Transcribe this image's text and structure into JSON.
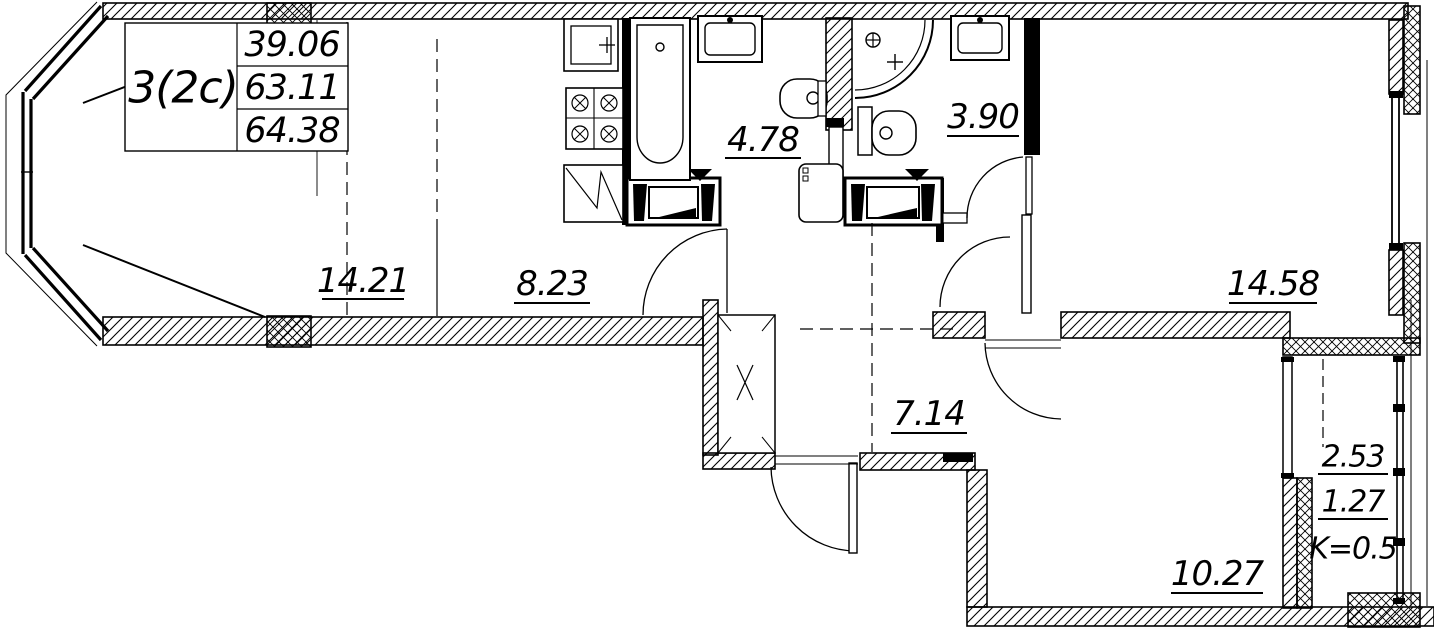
{
  "drawing": {
    "title_block": {
      "apartment_type": "3(2с)",
      "living_area": "39.06",
      "area": "63.11",
      "total_area": "64.38"
    },
    "room_labels": {
      "living": "14.21",
      "kitchen": "8.23",
      "bathroom": "4.78",
      "wc": "3.90",
      "bedroom_right": "14.58",
      "hallway": "7.14",
      "bedroom_bottom": "10.27",
      "balcony_full": "2.53",
      "balcony_reduced": "1.27",
      "balcony_coefficient": "K=0.5"
    },
    "colors": {
      "line": "#000000",
      "background": "#ffffff"
    }
  }
}
